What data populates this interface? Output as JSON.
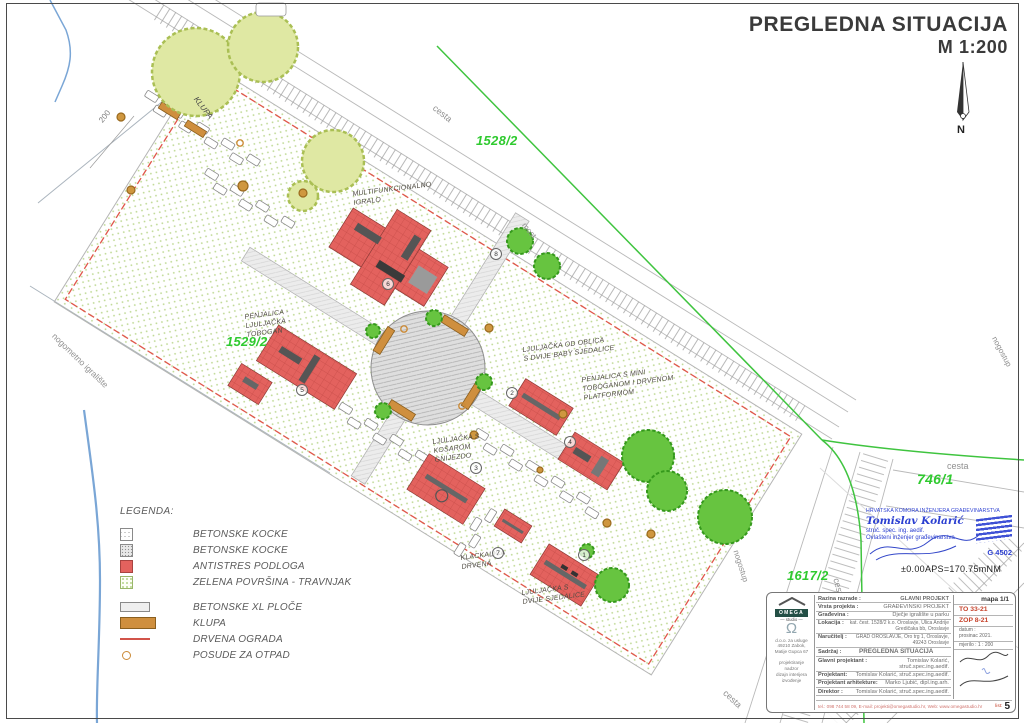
{
  "title": {
    "line1": "PREGLEDNA SITUACIJA",
    "line2": "M 1:200"
  },
  "compass": {
    "n": "N"
  },
  "parcels": {
    "p1528": "1528/2",
    "p1529": "1529/2",
    "p1617": "1617/2",
    "p746": "746/1"
  },
  "context": {
    "cesta_top": "cesta",
    "cesta_right": "cesta",
    "cesta_b1": "cesta",
    "cesta_b2": "cesta",
    "nogostup1": "nogostup",
    "nogostup2": "nogostup",
    "most": "most",
    "nogometno": "nogometno igralište",
    "klupa": "KLUPA",
    "dim200": "200"
  },
  "site": {
    "l1": {
      "num": "1",
      "text": "LJULJAČKA S\nDVIJE SJEDALICE"
    },
    "l2": {
      "num": "2",
      "text": "LJULJAČKA OD OBLICA\nS DVIJE BABY SJEDALICE"
    },
    "l3": {
      "num": "3",
      "text": "LJULJAČKA S\nKOŠAROM\nGNIJEZDO"
    },
    "l4": {
      "num": "4",
      "text": "PENJALICA S MINI\nTOBOGANOM I DRVENOM\nPLATFORMOM"
    },
    "l5": {
      "num": "5",
      "text": "PENJALICA -\nLJULJAČKA -\nTOBOGAN"
    },
    "l6": {
      "num": "6",
      "text": "MULTIFUNKCIONALNO\nIGRALO"
    },
    "l7": {
      "num": "7",
      "text": "KLACKALICA\nDRVENA"
    },
    "l8": {
      "num": "8",
      "text": ""
    }
  },
  "elevation": "±0.00APS=170.75mNM",
  "legend": {
    "title": "LEGENDA:",
    "items": [
      {
        "label": "BETONSKE KOCKE"
      },
      {
        "label": "BETONSKE KOCKE"
      },
      {
        "label": "ANTISTRES PODLOGA"
      },
      {
        "label": "ZELENA POVRŠINA - TRAVNJAK"
      },
      {
        "label": "BETONSKE XL PLOČE"
      },
      {
        "label": "KLUPA"
      },
      {
        "label": "DRVENA OGRADA"
      },
      {
        "label": "POSUDE ZA  OTPAD"
      }
    ]
  },
  "stamp": {
    "org": "HRVATSKA KOMORA INŽENJERA GRAĐEVINARSTVA",
    "name": "Tomislav Kolarić",
    "degree": "struč. spec. ing. aedif.",
    "role": "Ovlašteni inženjer građevinarstva",
    "number": "G 4502"
  },
  "titleblock": {
    "mapa": "mapa 1/1",
    "to": "TO 33-21",
    "zop": "ZOP 8-21",
    "datum_label": "datum :",
    "datum": "prosinac 2021.",
    "mjerilo_label": "mjerilo :",
    "mjerilo": "1 : 200",
    "rows": {
      "razina_label": "Razina razrade :",
      "razina": "GLAVNI PROJEKT",
      "vrsta_label": "Vrsta projekta :",
      "vrsta": "GRAĐEVINSKI PROJEKT",
      "gradevina_label": "Građevina :",
      "gradevina": "Dječje igralište u parku",
      "lokacija_label": "Lokacija :",
      "lokacija": "kat. čest. 1528/2 k.o. Oroslavje, Ulica Andrije Gredičaka bb, Oroslavje",
      "narucitelj_label": "Naručitelj :",
      "narucitelj": "GRAD OROSLAVJE, Oro trg 1, Oroslavje, 49243 Oroslavje",
      "sadrzaj_label": "Sadržaj :",
      "sadrzaj": "PREGLEDNA SITUACIJA",
      "glavni_label": "Glavni projektant :",
      "glavni": "Tomislav Kolarić, struč.spec.ing.aedif.",
      "projektant_label": "Projektant:",
      "projektant": "Tomislav Kolarić, struč.spec.ing.aedif.",
      "arhitekt_label": "Projektant arhitekture:",
      "arhitekt": "Marko Ljubić, dipl.ing.arh.",
      "direktor_label": "Direktor :",
      "direktor": "Tomislav Kolarić, struč.spec.ing.aedif."
    },
    "logo": {
      "name": "OMEGA",
      "sub": "— studio —",
      "omega": "Ω",
      "addr": "d.o.o. za usluge\n49210 Zabok,\nMatije Gupca 67",
      "services": "projektiranje\nnadzor\ndizajn interijera\nizvođenje"
    },
    "footer": {
      "contact": "tel.: 098 744 58 09, E-mail: projekti@omegastudio.hr, Web: www.omegastudio.hr",
      "list_label": "list:",
      "list": "5"
    }
  }
}
